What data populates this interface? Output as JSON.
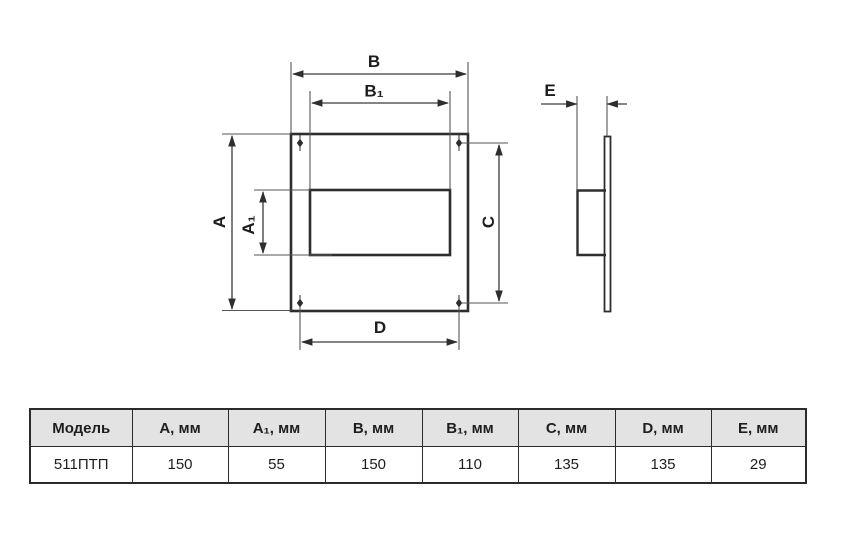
{
  "drawing": {
    "labels": {
      "a": "A",
      "a1": "A₁",
      "b": "B",
      "b1": "B₁",
      "c": "C",
      "d": "D",
      "e": "E"
    }
  },
  "table": {
    "headers": [
      "Модель",
      "А, мм",
      "А₁, мм",
      "В, мм",
      "В₁, мм",
      "С, мм",
      "D, мм",
      "Е, мм"
    ],
    "row": [
      "511ПТП",
      "150",
      "55",
      "150",
      "110",
      "135",
      "135",
      "29"
    ]
  },
  "colors": {
    "object_line": "#2e2e2e",
    "dimension_line": "#565656",
    "label_text": "#1d1d1d",
    "table_header_bg": "#e3e3e3",
    "table_border": "#2b2b2b",
    "background": "#ffffff"
  }
}
